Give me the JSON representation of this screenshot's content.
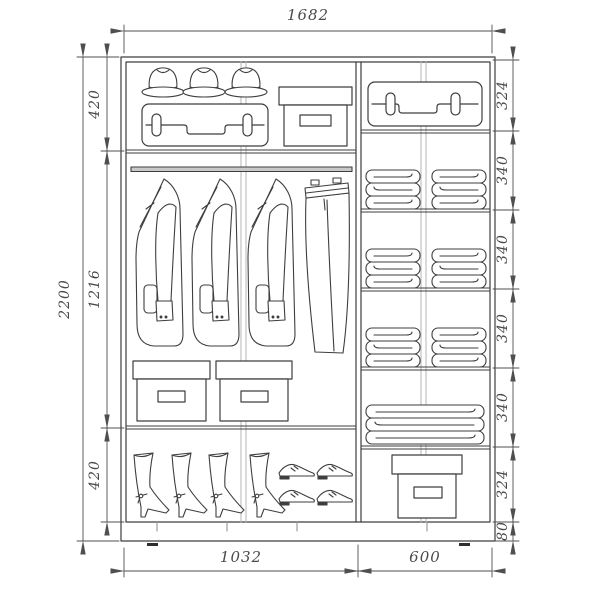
{
  "meta": {
    "type": "technical-drawing",
    "subject": "sliding-wardrobe interior layout with dimensions"
  },
  "dims": {
    "width_total": "1682",
    "height_total": "2200",
    "left_sections": [
      "420",
      "1216",
      "420"
    ],
    "right_sections": [
      "324",
      "340",
      "340",
      "340",
      "340",
      "324",
      "80"
    ],
    "bottom_widths": [
      "1032",
      "600"
    ]
  },
  "contents": {
    "left_top_shelf": [
      "hat-icon",
      "hat-icon",
      "hat-icon",
      "suitcase-icon",
      "storage-box-icon"
    ],
    "left_hanging_area": [
      "hanging-rod",
      "jacket-icon",
      "jacket-icon",
      "jacket-icon",
      "pants-icon",
      "storage-box-icon",
      "storage-box-icon"
    ],
    "left_bottom_shelf": [
      "boot-icon",
      "boot-icon",
      "boot-icon",
      "boot-icon",
      "shoe-icon",
      "shoe-icon",
      "shoe-icon",
      "shoe-icon"
    ],
    "right_column": [
      "suitcase-icon",
      "folded-clothes-icon",
      "folded-clothes-icon",
      "folded-clothes-icon",
      "folded-clothes-icon",
      "folded-clothes-icon",
      "folded-clothes-icon",
      "blanket-icon",
      "storage-box-icon"
    ]
  },
  "colors": {
    "background": "#ffffff",
    "line": "#3e3e3e",
    "dimension": "#4f4f4f",
    "door_line": "#b5b5b5"
  }
}
